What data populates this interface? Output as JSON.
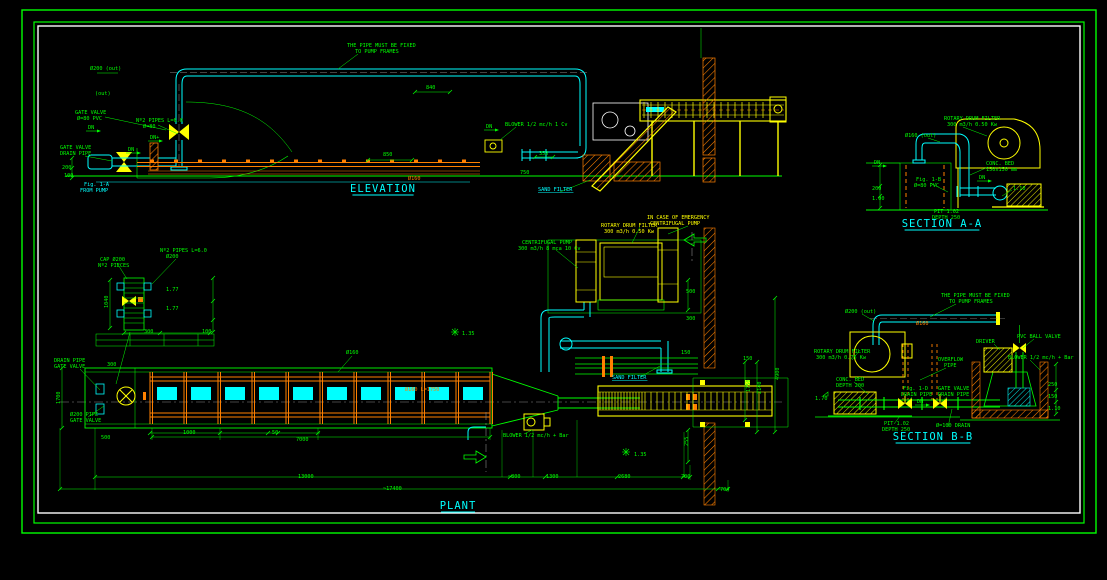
{
  "sheet": {
    "type": "cad-piping-drawing",
    "background": "#000000",
    "frame_colors": [
      "#00ff00",
      "#00ff00",
      "#ffffff"
    ],
    "palette": {
      "green": "#00ff00",
      "cyan": "#00ffff",
      "yellow": "#ffff00",
      "orange": "#ff8000",
      "white": "#ffffff",
      "gray": "#888888"
    }
  },
  "titles": [
    {
      "t": "ELEVATION",
      "x": 383,
      "y": 192
    },
    {
      "t": "SECTION A-A",
      "x": 942,
      "y": 227
    },
    {
      "t": "PLANT",
      "x": 458,
      "y": 509
    },
    {
      "t": "SECTION B-B",
      "x": 933,
      "y": 440
    }
  ],
  "labels": [
    {
      "t": "THE PIPE MUST BE FIXED",
      "x": 347,
      "y": 47,
      "c": "g"
    },
    {
      "t": "TO PUMP FRAMES",
      "x": 355,
      "y": 53,
      "c": "g"
    },
    {
      "t": "Ø200 (out)",
      "x": 90,
      "y": 70,
      "c": "g"
    },
    {
      "t": "(out)",
      "x": 95,
      "y": 95,
      "c": "g"
    },
    {
      "t": "GATE VALVE",
      "x": 75,
      "y": 114,
      "c": "g"
    },
    {
      "t": "Ø=80 PVC",
      "x": 77,
      "y": 120,
      "c": "g"
    },
    {
      "t": "Nº2 PIPES L=6.0",
      "x": 136,
      "y": 122,
      "c": "g"
    },
    {
      "t": "Ø=80",
      "x": 143,
      "y": 128,
      "c": "g"
    },
    {
      "t": "DN",
      "x": 88,
      "y": 129,
      "c": "g"
    },
    {
      "t": "DN+",
      "x": 150,
      "y": 139,
      "c": "g"
    },
    {
      "t": "DN",
      "x": 128,
      "y": 151,
      "c": "g"
    },
    {
      "t": "GATE VALVE",
      "x": 60,
      "y": 149,
      "c": "g"
    },
    {
      "t": "DRAIN PIPE",
      "x": 60,
      "y": 155,
      "c": "g"
    },
    {
      "t": "200",
      "x": 62,
      "y": 169,
      "c": "g"
    },
    {
      "t": "100",
      "x": 64,
      "y": 177,
      "c": "g"
    },
    {
      "t": "Fig. 1-A",
      "x": 84,
      "y": 186,
      "c": "c"
    },
    {
      "t": "FROM PUMP",
      "x": 80,
      "y": 192,
      "c": "c"
    },
    {
      "t": "840",
      "x": 426,
      "y": 89,
      "c": "g"
    },
    {
      "t": "850",
      "x": 383,
      "y": 156,
      "c": "g"
    },
    {
      "t": "DN",
      "x": 486,
      "y": 128,
      "c": "g"
    },
    {
      "t": "BLOWER 1/2 mc/h 1 Cv",
      "x": 505,
      "y": 126,
      "c": "g"
    },
    {
      "t": "350",
      "x": 539,
      "y": 155,
      "c": "g"
    },
    {
      "t": "750",
      "x": 520,
      "y": 174,
      "c": "g"
    },
    {
      "t": "Ø160",
      "x": 408,
      "y": 180,
      "c": "o"
    },
    {
      "t": "SAND FILTER",
      "x": 538,
      "y": 191,
      "c": "c",
      "u": 1
    },
    {
      "t": "ROTARY DRUM FILTER",
      "x": 944,
      "y": 120,
      "c": "g"
    },
    {
      "t": "300 m3/h 0.50 Kw",
      "x": 947,
      "y": 126,
      "c": "g"
    },
    {
      "t": "Ø160 (out)",
      "x": 905,
      "y": 137,
      "c": "g"
    },
    {
      "t": "DN",
      "x": 874,
      "y": 164,
      "c": "g"
    },
    {
      "t": "CONC. BED",
      "x": 986,
      "y": 165,
      "c": "g"
    },
    {
      "t": "150x150 mm",
      "x": 986,
      "y": 171,
      "c": "g"
    },
    {
      "t": "Fig. 1-B",
      "x": 916,
      "y": 181,
      "c": "g"
    },
    {
      "t": "Ø=80 PVC",
      "x": 914,
      "y": 187,
      "c": "g"
    },
    {
      "t": "DN",
      "x": 979,
      "y": 179,
      "c": "g"
    },
    {
      "t": "1.10",
      "x": 1013,
      "y": 190,
      "c": "g"
    },
    {
      "t": "200",
      "x": 872,
      "y": 190,
      "c": "g"
    },
    {
      "t": "1.00",
      "x": 872,
      "y": 200,
      "c": "g"
    },
    {
      "t": "PIT 1.02",
      "x": 934,
      "y": 213,
      "c": "g"
    },
    {
      "t": "DEPTH 250",
      "x": 932,
      "y": 219,
      "c": "g"
    },
    {
      "t": "CENTRIFUGAL PUMP",
      "x": 522,
      "y": 244,
      "c": "g"
    },
    {
      "t": "300 m3/h 8 mca 10 Cv",
      "x": 518,
      "y": 250,
      "c": "g"
    },
    {
      "t": "ROTARY DRUM FILTER",
      "x": 601,
      "y": 227,
      "c": "y"
    },
    {
      "t": "300 m3/h 0.50 Kw",
      "x": 604,
      "y": 233,
      "c": "y"
    },
    {
      "t": "IN CASE OF EMERGENCY",
      "x": 647,
      "y": 219,
      "c": "y"
    },
    {
      "t": "CENTRIFUGAL PUMP",
      "x": 650,
      "y": 225,
      "c": "y"
    },
    {
      "t": "CAP Ø200",
      "x": 100,
      "y": 261,
      "c": "g"
    },
    {
      "t": "Nº2 PIECES",
      "x": 98,
      "y": 267,
      "c": "g"
    },
    {
      "t": "Nº2 PIPES L=6.0",
      "x": 160,
      "y": 252,
      "c": "g"
    },
    {
      "t": "Ø200",
      "x": 166,
      "y": 258,
      "c": "g"
    },
    {
      "t": "1.77",
      "x": 166,
      "y": 291,
      "c": "g"
    },
    {
      "t": "1.77",
      "x": 166,
      "y": 310,
      "c": "g"
    },
    {
      "t": "1040",
      "x": 108,
      "y": 308,
      "c": "g",
      "r": -90
    },
    {
      "t": "300",
      "x": 144,
      "y": 333,
      "c": "g"
    },
    {
      "t": "100",
      "x": 202,
      "y": 333,
      "c": "g"
    },
    {
      "t": "DRAIN PIPE",
      "x": 54,
      "y": 362,
      "c": "g"
    },
    {
      "t": "GATE VALVE",
      "x": 54,
      "y": 368,
      "c": "g"
    },
    {
      "t": "300",
      "x": 107,
      "y": 366,
      "c": "g"
    },
    {
      "t": "1700",
      "x": 60,
      "y": 404,
      "c": "g",
      "r": -90
    },
    {
      "t": "Ø200 PIPE",
      "x": 70,
      "y": 416,
      "c": "g"
    },
    {
      "t": "GATE VALVE",
      "x": 70,
      "y": 422,
      "c": "g"
    },
    {
      "t": "500",
      "x": 101,
      "y": 439,
      "c": "g"
    },
    {
      "t": "1000",
      "x": 183,
      "y": 434,
      "c": "g"
    },
    {
      "t": "50",
      "x": 272,
      "y": 434,
      "c": "g"
    },
    {
      "t": "7000",
      "x": 296,
      "y": 441,
      "c": "g"
    },
    {
      "t": "13000",
      "x": 298,
      "y": 478,
      "c": "g"
    },
    {
      "t": "~17400",
      "x": 383,
      "y": 490,
      "c": "g"
    },
    {
      "t": "Ø160",
      "x": 346,
      "y": 354,
      "c": "g"
    },
    {
      "t": "SAND FILTER",
      "x": 612,
      "y": 379,
      "c": "c",
      "u": 1
    },
    {
      "t": "Ø160 L=1750",
      "x": 405,
      "y": 391,
      "c": "o"
    },
    {
      "t": "BLOWER 1/2 mc/h + Bar",
      "x": 503,
      "y": 437,
      "c": "g"
    },
    {
      "t": "1.35",
      "x": 462,
      "y": 335,
      "c": "g"
    },
    {
      "t": "1.35",
      "x": 634,
      "y": 456,
      "c": "g"
    },
    {
      "t": "500",
      "x": 686,
      "y": 293,
      "c": "g"
    },
    {
      "t": "300",
      "x": 686,
      "y": 320,
      "c": "g"
    },
    {
      "t": "150",
      "x": 681,
      "y": 354,
      "c": "g"
    },
    {
      "t": "150",
      "x": 743,
      "y": 360,
      "c": "g"
    },
    {
      "t": "1750",
      "x": 750,
      "y": 392,
      "c": "g",
      "r": -90
    },
    {
      "t": "2140",
      "x": 761,
      "y": 394,
      "c": "g",
      "r": -90
    },
    {
      "t": "4900",
      "x": 779,
      "y": 380,
      "c": "g",
      "r": -90
    },
    {
      "t": "255",
      "x": 688,
      "y": 446,
      "c": "g",
      "r": -90
    },
    {
      "t": "~800",
      "x": 508,
      "y": 478,
      "c": "g"
    },
    {
      "t": "1300",
      "x": 546,
      "y": 478,
      "c": "g"
    },
    {
      "t": "2680",
      "x": 618,
      "y": 478,
      "c": "g"
    },
    {
      "t": "700",
      "x": 681,
      "y": 478,
      "c": "g"
    },
    {
      "t": "704",
      "x": 720,
      "y": 491,
      "c": "g"
    },
    {
      "t": "THE PIPE MUST BE FIXED",
      "x": 941,
      "y": 297,
      "c": "g"
    },
    {
      "t": "TO PUMP FRAMES",
      "x": 949,
      "y": 303,
      "c": "g"
    },
    {
      "t": "Ø200 (out)",
      "x": 845,
      "y": 313,
      "c": "g"
    },
    {
      "t": "Ø160",
      "x": 916,
      "y": 325,
      "c": "o"
    },
    {
      "t": "ROTARY DRUM FILTER",
      "x": 814,
      "y": 353,
      "c": "g"
    },
    {
      "t": "300 m3/h 0.75 Kw",
      "x": 816,
      "y": 359,
      "c": "g"
    },
    {
      "t": "DRIVER",
      "x": 976,
      "y": 343,
      "c": "g"
    },
    {
      "t": "PVC BALL VALVE",
      "x": 1017,
      "y": 338,
      "c": "g"
    },
    {
      "t": "BLOWER 1/2 mc/h + Bar",
      "x": 1008,
      "y": 359,
      "c": "g"
    },
    {
      "t": "OVERFLOW",
      "x": 938,
      "y": 361,
      "c": "g"
    },
    {
      "t": "PIPE",
      "x": 944,
      "y": 367,
      "c": "g"
    },
    {
      "t": "CONC. BED",
      "x": 836,
      "y": 381,
      "c": "g"
    },
    {
      "t": "DEPTH 200",
      "x": 836,
      "y": 387,
      "c": "g"
    },
    {
      "t": "Fig. 1-D",
      "x": 903,
      "y": 390,
      "c": "g"
    },
    {
      "t": "DRAIN PIPE",
      "x": 901,
      "y": 396,
      "c": "g"
    },
    {
      "t": "GATE VALVE",
      "x": 938,
      "y": 390,
      "c": "g"
    },
    {
      "t": "DRAIN PIPE",
      "x": 938,
      "y": 396,
      "c": "g"
    },
    {
      "t": "1.70",
      "x": 815,
      "y": 400,
      "c": "g"
    },
    {
      "t": "DN",
      "x": 917,
      "y": 403,
      "c": "g"
    },
    {
      "t": "PIT 1.02",
      "x": 884,
      "y": 425,
      "c": "g"
    },
    {
      "t": "DEPTH 250",
      "x": 882,
      "y": 431,
      "c": "g"
    },
    {
      "t": "Ø=100 DRAIN",
      "x": 936,
      "y": 427,
      "c": "g"
    },
    {
      "t": "250",
      "x": 1048,
      "y": 386,
      "c": "g"
    },
    {
      "t": "150",
      "x": 1048,
      "y": 398,
      "c": "g"
    },
    {
      "t": "1.10",
      "x": 1048,
      "y": 410,
      "c": "g"
    }
  ]
}
